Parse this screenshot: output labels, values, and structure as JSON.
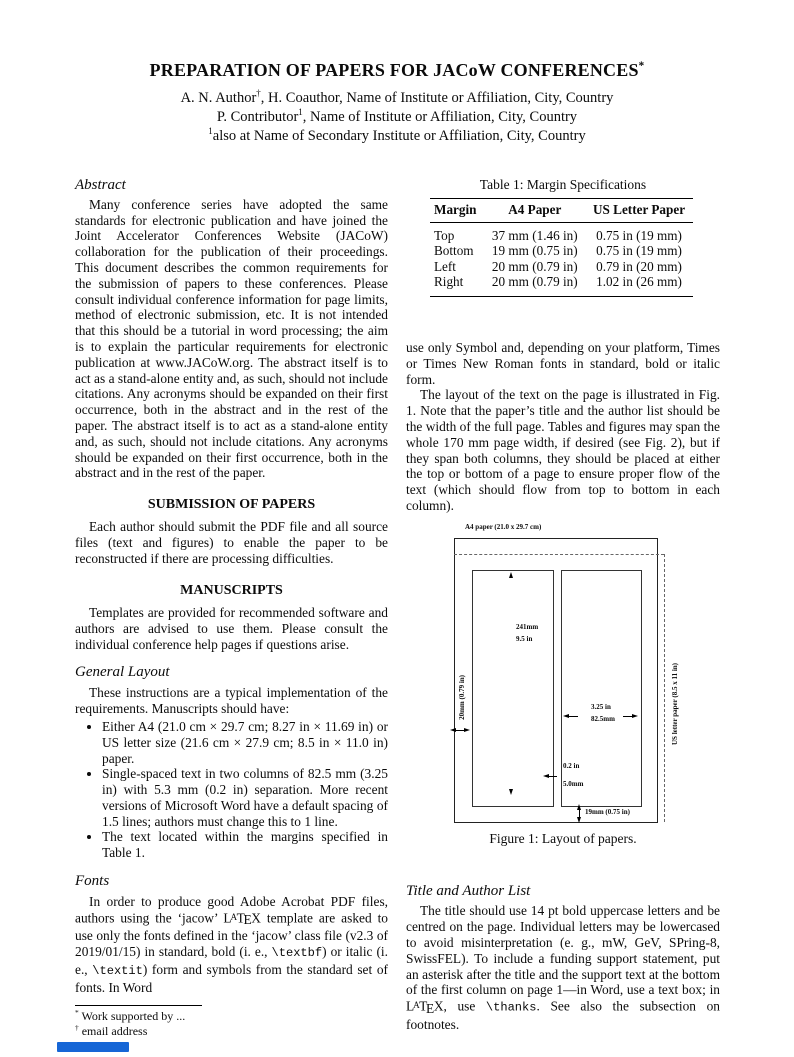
{
  "colors": {
    "status_bar_blue": "#1666d6",
    "text": "#0b0b0b",
    "page_background": "#ffffff"
  },
  "header": {
    "title": [
      {
        "t": "PREPARATION OF PAPERS FOR JACoW CONFERENCES"
      },
      {
        "t": "*",
        "s": "sup"
      }
    ],
    "author_line1": [
      {
        "t": "A. N. Author"
      },
      {
        "t": "†",
        "s": "sup"
      },
      {
        "t": ", H. Coauthor, Name of Institute or Affiliation, City, Country"
      }
    ],
    "author_line2": [
      {
        "t": "P. Contributor"
      },
      {
        "t": "1",
        "s": "sup"
      },
      {
        "t": ", Name of Institute or Affiliation, City, Country"
      }
    ],
    "author_line3": [
      {
        "t": "1",
        "s": "sup"
      },
      {
        "t": "also at Name of Secondary Institute or Affiliation, City, Country"
      }
    ]
  },
  "left": {
    "abstract": {
      "heading": "Abstract",
      "text": "Many conference series have adopted the same standards for electronic publication and have joined the Joint Accelerator Conferences Website (JACoW) collaboration for the publication of their proceedings. This document describes the common requirements for the submission of papers to these conferences. Please consult individual conference information for page limits, method of electronic submission, etc. It is not intended that this should be a tutorial in word processing; the aim is to explain the particular requirements for electronic publication at www.JACoW.org. The abstract itself is to act as a stand-alone entity and, as such, should not include citations. Any acronyms should be expanded on their first occurrence, both in the abstract and in the rest of the paper. The abstract itself is to act as a stand-alone entity and, as such, should not include citations. Any acronyms should be expanded on their first occurrence, both in the abstract and in the rest of the paper."
    },
    "submission": {
      "heading": "SUBMISSION OF PAPERS",
      "text": "Each author should submit the PDF file and all source files (text and figures) to enable the paper to be reconstructed if there are processing difficulties."
    },
    "manuscripts": {
      "heading": "MANUSCRIPTS",
      "text": "Templates are provided for recommended software and authors are advised to use them. Please consult the individual conference help pages if questions arise."
    },
    "general_layout": {
      "heading": "General Layout",
      "intro": "These instructions are a typical implementation of the requirements. Manuscripts should have:",
      "bullets": [
        "Either A4 (21.0 cm × 29.7 cm; 8.27 in × 11.69 in) or US letter size (21.6 cm × 27.9 cm; 8.5 in × 11.0 in) paper.",
        "Single-spaced text in two columns of 82.5 mm (3.25 in) with 5.3 mm (0.2 in) separation. More recent versions of Microsoft Word have a default spacing of 1.5 lines; authors must change this to 1 line.",
        "The text located within the margins specified in Table 1."
      ]
    },
    "fonts": {
      "heading": "Fonts",
      "para": [
        {
          "t": "In order to produce good Adobe Acrobat PDF files, authors using the ‘jacow’ "
        },
        {
          "t": "L"
        },
        {
          "t": "A",
          "s": "latexA"
        },
        {
          "t": "T"
        },
        {
          "t": "E",
          "s": "latexE"
        },
        {
          "t": "X"
        },
        {
          "t": " template are asked to use only the fonts defined in the ‘jacow’ class file (v2.3 of 2019/01/15) in standard, bold (i. e., "
        },
        {
          "t": "\\textbf",
          "s": "tt"
        },
        {
          "t": ") or italic (i. e., "
        },
        {
          "t": "\\textit",
          "s": "tt"
        },
        {
          "t": ") form and symbols from the standard set of fonts. In Word"
        }
      ]
    },
    "footnotes": [
      [
        {
          "t": "*",
          "s": "sup"
        },
        {
          "t": " Work supported by ..."
        }
      ],
      [
        {
          "t": "†",
          "s": "sup"
        },
        {
          "t": " email address"
        }
      ]
    ]
  },
  "right": {
    "table": {
      "caption": "Table 1: Margin Specifications",
      "headers": [
        "Margin",
        "A4 Paper",
        "US Letter Paper"
      ],
      "rows": [
        [
          "Top",
          "37 mm (1.46 in)",
          "0.75 in (19 mm)"
        ],
        [
          "Bottom",
          "19 mm (0.75 in)",
          "0.75 in (19 mm)"
        ],
        [
          "Left",
          "20 mm (0.79 in)",
          "0.79 in (20 mm)"
        ],
        [
          "Right",
          "20 mm (0.79 in)",
          "1.02 in (26 mm)"
        ]
      ]
    },
    "para_symbol": "use only Symbol and, depending on your platform, Times or Times New Roman fonts in standard, bold or italic form.",
    "para_layout": "The layout of the text on the page is illustrated in Fig. 1. Note that the paper’s title and the author list should be the width of the full page. Tables and figures may span the whole 170 mm page width, if desired (see Fig. 2), but if they span both columns, they should be placed at either the top or bottom of a page to ensure proper flow of the text (which should flow from top to bottom in each column).",
    "figure": {
      "a4_label": "A4 paper (21.0 x 29.7 cm)",
      "col_height_mm": "241mm",
      "col_height_in": "9.5 in",
      "left_margin": "20mm (0.79 in)",
      "col_width_in": "3.25 in",
      "col_width_mm": "82.5mm",
      "gap_in": "0.2 in",
      "gap_mm": "5.0mm",
      "bottom_margin": "19mm (0.75 in)",
      "us_letter": "US letter paper (8.5 x 11 in)",
      "caption": "Figure 1: Layout of papers."
    },
    "title_author": {
      "heading": "Title and Author List",
      "para": [
        {
          "t": "The title should use 14 pt bold uppercase letters and be centred on the page. Individual letters may be lowercased to avoid misinterpretation (e. g., mW, GeV, SPring-8, SwissFEL). To include a funding support statement, put an asterisk after the title and the support text at the bottom of the first column on page 1—in Word, use a text box; in "
        },
        {
          "t": "L"
        },
        {
          "t": "A",
          "s": "latexA"
        },
        {
          "t": "T"
        },
        {
          "t": "E",
          "s": "latexE"
        },
        {
          "t": "X"
        },
        {
          "t": ", use "
        },
        {
          "t": "\\thanks",
          "s": "tt"
        },
        {
          "t": ". See also the subsection on footnotes."
        }
      ]
    }
  }
}
